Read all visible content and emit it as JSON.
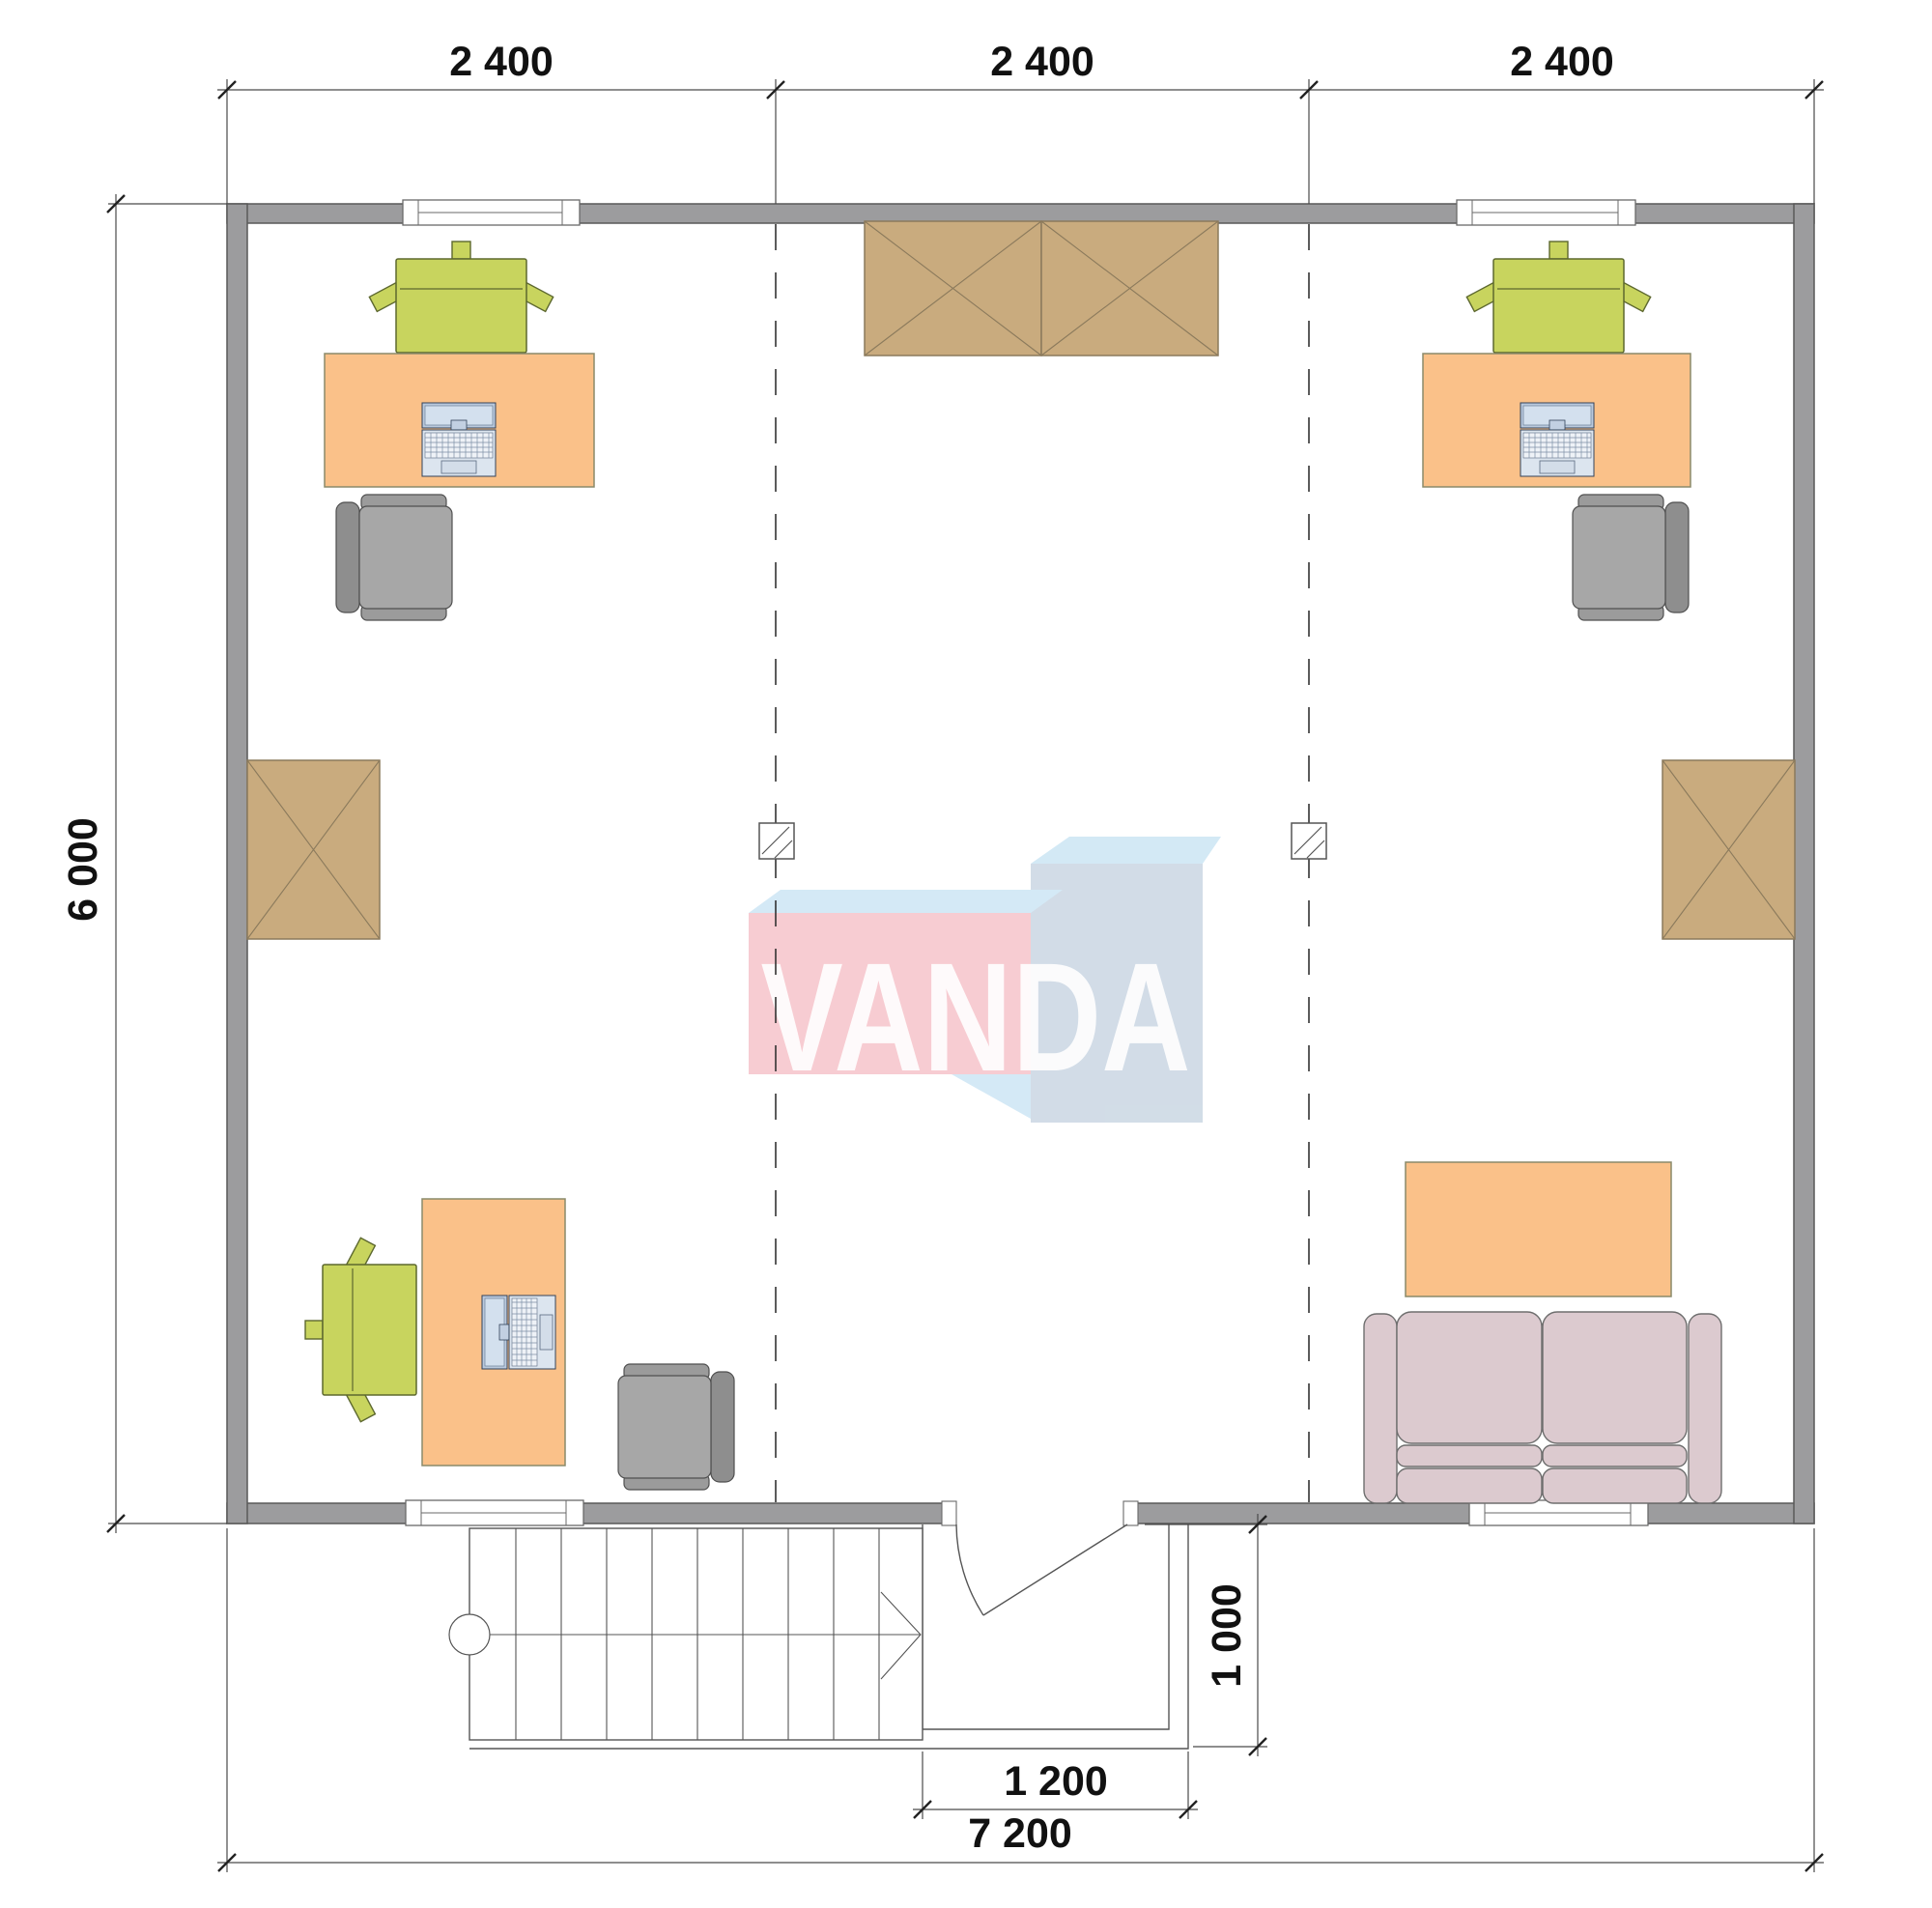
{
  "page": {
    "type": "architectural floor plan, top view",
    "background": "#ffffff"
  },
  "watermark": {
    "text": "VANDA",
    "pink_front": "#f7c6cc",
    "sky_face": "#cfe7f5",
    "blue_top": "#cde6f4",
    "blue_front": "#ccd8e4",
    "text_color": "#ffffff"
  },
  "dimensions": {
    "top_segments": [
      "2 400",
      "2 400",
      "2 400"
    ],
    "side_total": "6 000",
    "bottom_total": "7 200",
    "entry_width": "1 200",
    "entry_depth": "1 000"
  },
  "colors": {
    "wall": "#9c9c9e",
    "wall_outline": "#595959",
    "wardrobe": "#c9ab7e",
    "wardrobe_outline": "#8b7a5c",
    "desk": "#fac189",
    "desk_outline": "#8a8a6a",
    "chair_green": "#c8d45e",
    "chair_green_outline": "#5d682f",
    "chair_gray": "#a7a7a7",
    "chair_gray_back": "#8e8e8e",
    "chair_gray_outline": "#4f4f4f",
    "sofa": "#dccacf",
    "sofa_outline": "#6e6e6e",
    "laptop_screen": "#b9c9dd",
    "laptop_body": "#dce5ef",
    "dimension_text": "#111111"
  },
  "furniture_icons": [
    "desk-top-left",
    "laptop-top-left",
    "task-chair-top-left",
    "office-chair-top-left",
    "desk-top-right",
    "laptop-top-right",
    "task-chair-top-right",
    "office-chair-top-right",
    "desk-bottom-left",
    "laptop-bottom-left",
    "task-chair-bottom-left",
    "office-chair-bottom-left",
    "wardrobe-top-left-unit",
    "wardrobe-top-right-unit",
    "wardrobe-left-wall",
    "wardrobe-right-wall",
    "coffee-table",
    "sofa",
    "staircase",
    "porch",
    "entry-door",
    "column-left",
    "column-right"
  ]
}
